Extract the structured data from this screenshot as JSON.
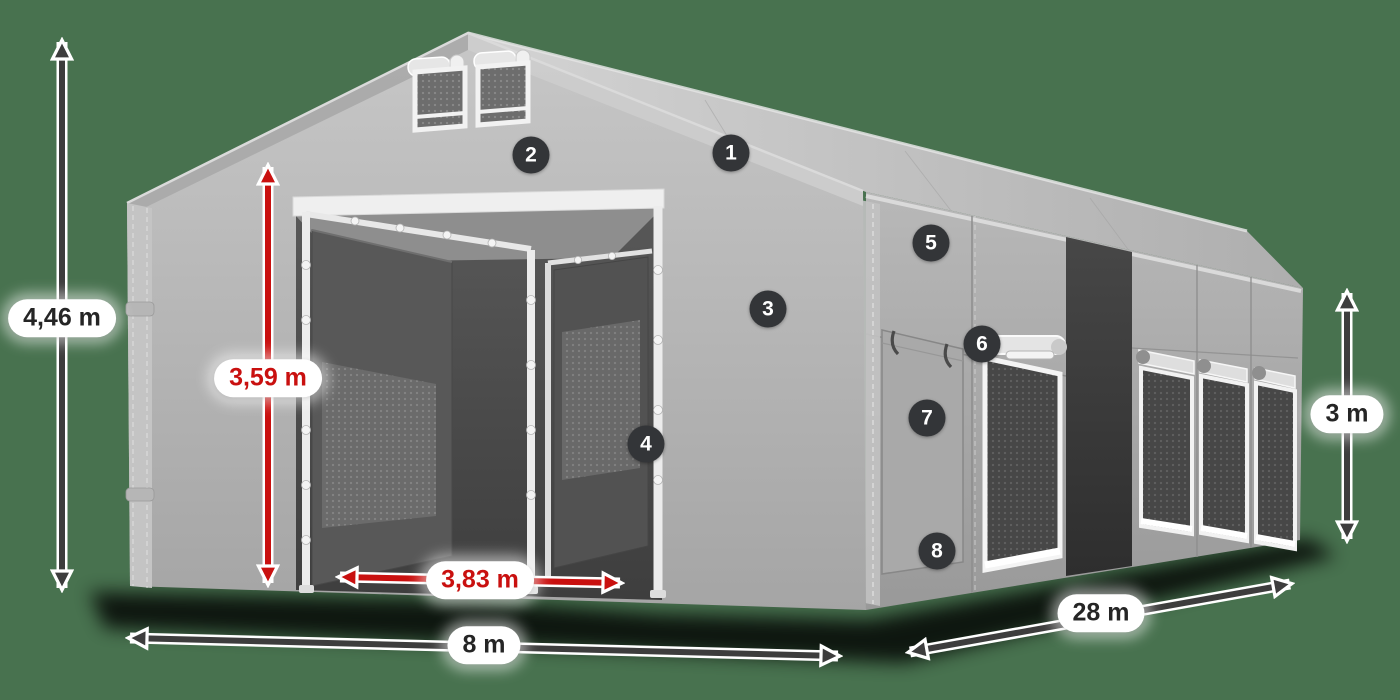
{
  "scene": {
    "description": "3D render of a grey storage marquee tent with dimension arrows and numbered feature hotspots",
    "background_color": "#48724f",
    "accent_red": "#c9100f",
    "arrow_color": "#3d3d3d",
    "badge_color": "#333538",
    "tent_color": "#b5b5b5"
  },
  "dimensions": {
    "overall_height": "4,46 m",
    "entrance_height": "3,59 m",
    "entrance_width": "3,83 m",
    "front_width": "8 m",
    "side_length": "28 m",
    "side_wall_height": "3 m"
  },
  "callouts": [
    "1",
    "2",
    "3",
    "4",
    "5",
    "6",
    "7",
    "8"
  ]
}
